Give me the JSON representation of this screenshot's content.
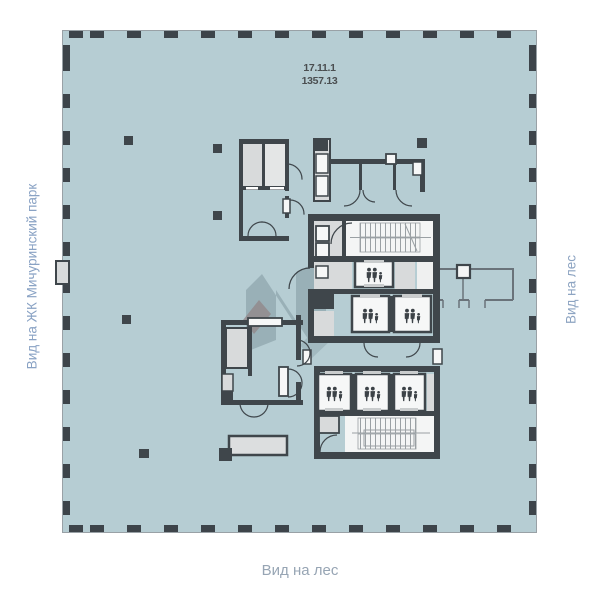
{
  "title": {
    "unit_number": "17.11.1",
    "area": "1357.13"
  },
  "view_labels": {
    "left": "Вид на ЖК Мичуринский парк",
    "right": "Вид на лес",
    "bottom": "Вид на лес"
  },
  "plan": {
    "type": "floor-plan",
    "elevator_cabins": 6,
    "figures_per_elevator_icon": 3,
    "stairwells": 2,
    "colors": {
      "floor_fill": "#b6cdd3",
      "wall": "#3f464b",
      "room_gray": "#d8dadb",
      "room_white": "#f4f5f5",
      "facade_mullion": "#3d444a",
      "facade_line": "#99a1a6",
      "label_blue": "#89a2c4",
      "label_gray": "#97a5b4",
      "number_dark": "#4a4e50",
      "watermark_teal": "#7e959d",
      "watermark_maroon": "#6e4444"
    },
    "icons": [
      "elevator-occupancy-icon",
      "stair-treads",
      "door-swing-arc",
      "structural-column"
    ]
  }
}
